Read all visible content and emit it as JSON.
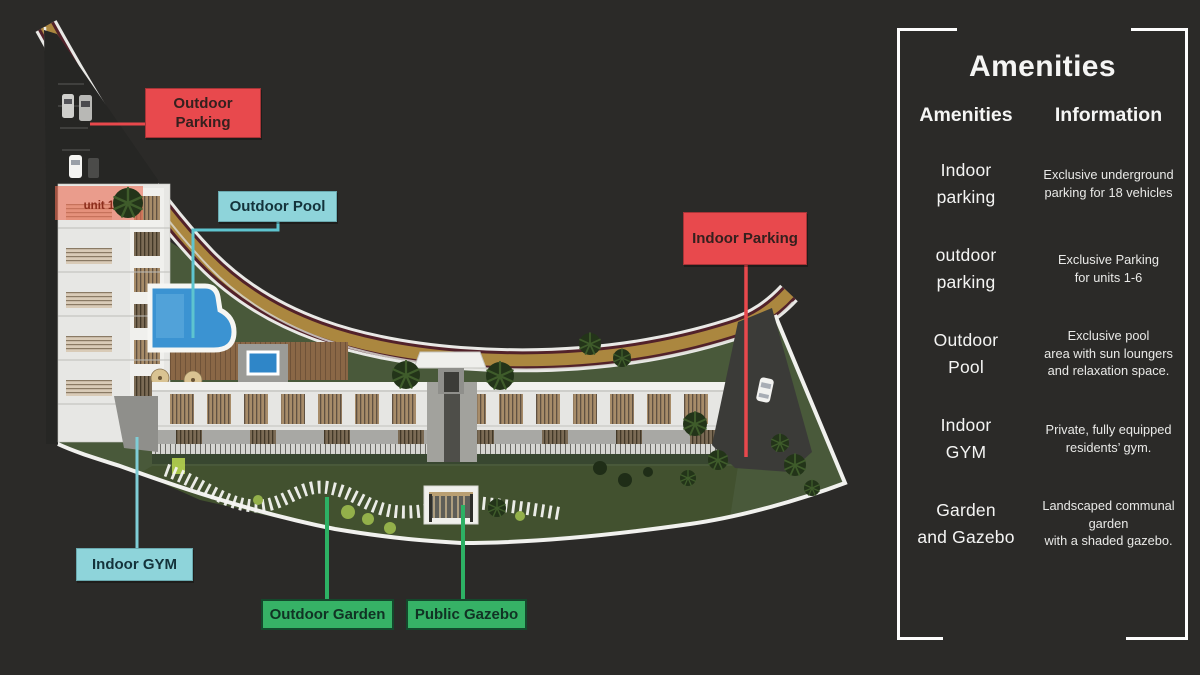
{
  "colors": {
    "background": "#2b2a28",
    "accent_red": "#e8494d",
    "accent_teal": "#8ed4da",
    "accent_green": "#36b266",
    "road_gold": "#ab873f",
    "lawn_green": "#49593a",
    "pool_blue": "#3b93d2"
  },
  "plan": {
    "unit_overlay_label": "unit 1",
    "callouts": [
      {
        "id": "outdoor-parking",
        "text": "Outdoor Parking"
      },
      {
        "id": "outdoor-pool",
        "text": "Outdoor Pool"
      },
      {
        "id": "indoor-parking",
        "text": "Indoor Parking"
      },
      {
        "id": "indoor-gym",
        "text": "Indoor GYM"
      },
      {
        "id": "outdoor-garden",
        "text": "Outdoor Garden"
      },
      {
        "id": "public-gazebo",
        "text": "Public Gazebo"
      }
    ]
  },
  "panel": {
    "title": "Amenities",
    "columns": [
      "Amenities",
      "Information"
    ],
    "rows": [
      {
        "amenity": "Indoor\nparking",
        "info": "Exclusive underground\nparking for 18 vehicles"
      },
      {
        "amenity": "outdoor\nparking",
        "info": "Exclusive Parking\nfor units 1-6"
      },
      {
        "amenity": "Outdoor\nPool",
        "info": "Exclusive pool\narea with sun loungers\nand relaxation space."
      },
      {
        "amenity": "Indoor\nGYM",
        "info": "Private, fully equipped\nresidents’ gym."
      },
      {
        "amenity": "Garden\nand Gazebo",
        "info": "Landscaped communal\ngarden\nwith a shaded gazebo."
      }
    ]
  }
}
